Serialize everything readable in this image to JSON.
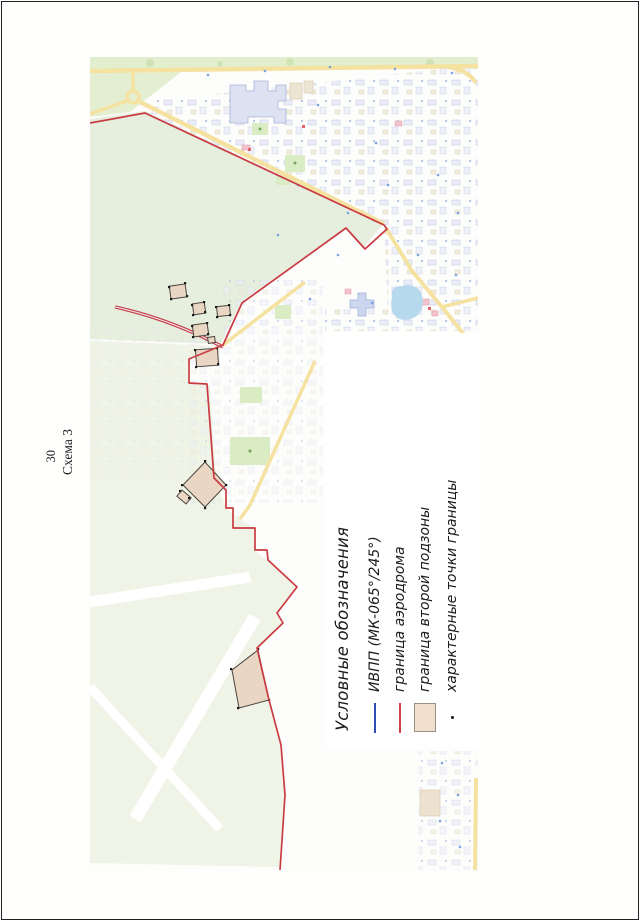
{
  "page": {
    "number": "30",
    "caption": "Схема 3"
  },
  "legend": {
    "title": "Условные обозначения",
    "items": [
      {
        "id": "runway",
        "label": "ИВПП (МК-065°/245°)",
        "symbol": "line",
        "color": "#2e4fb4"
      },
      {
        "id": "aerodrome",
        "label": "граница аэродрома",
        "symbol": "line",
        "color": "#d23b47"
      },
      {
        "id": "subzone",
        "label": "граница второй подзоны",
        "symbol": "rect",
        "color": "#f0e0cd"
      },
      {
        "id": "points",
        "label": "характерные точки границы",
        "symbol": "dot",
        "color": "#1a1a1a"
      }
    ]
  },
  "map": {
    "colors": {
      "field_green": "#e6eedd",
      "pale_fields": "#f0f4e6",
      "road_yellow": "#f5e2a0",
      "motorway_red": "#c4414d",
      "pond_blue": "#b7d9ee",
      "boundary_red": "#c93b42",
      "subzone_fill": "#e9d6c3",
      "top_green": "#e2efcf"
    }
  }
}
